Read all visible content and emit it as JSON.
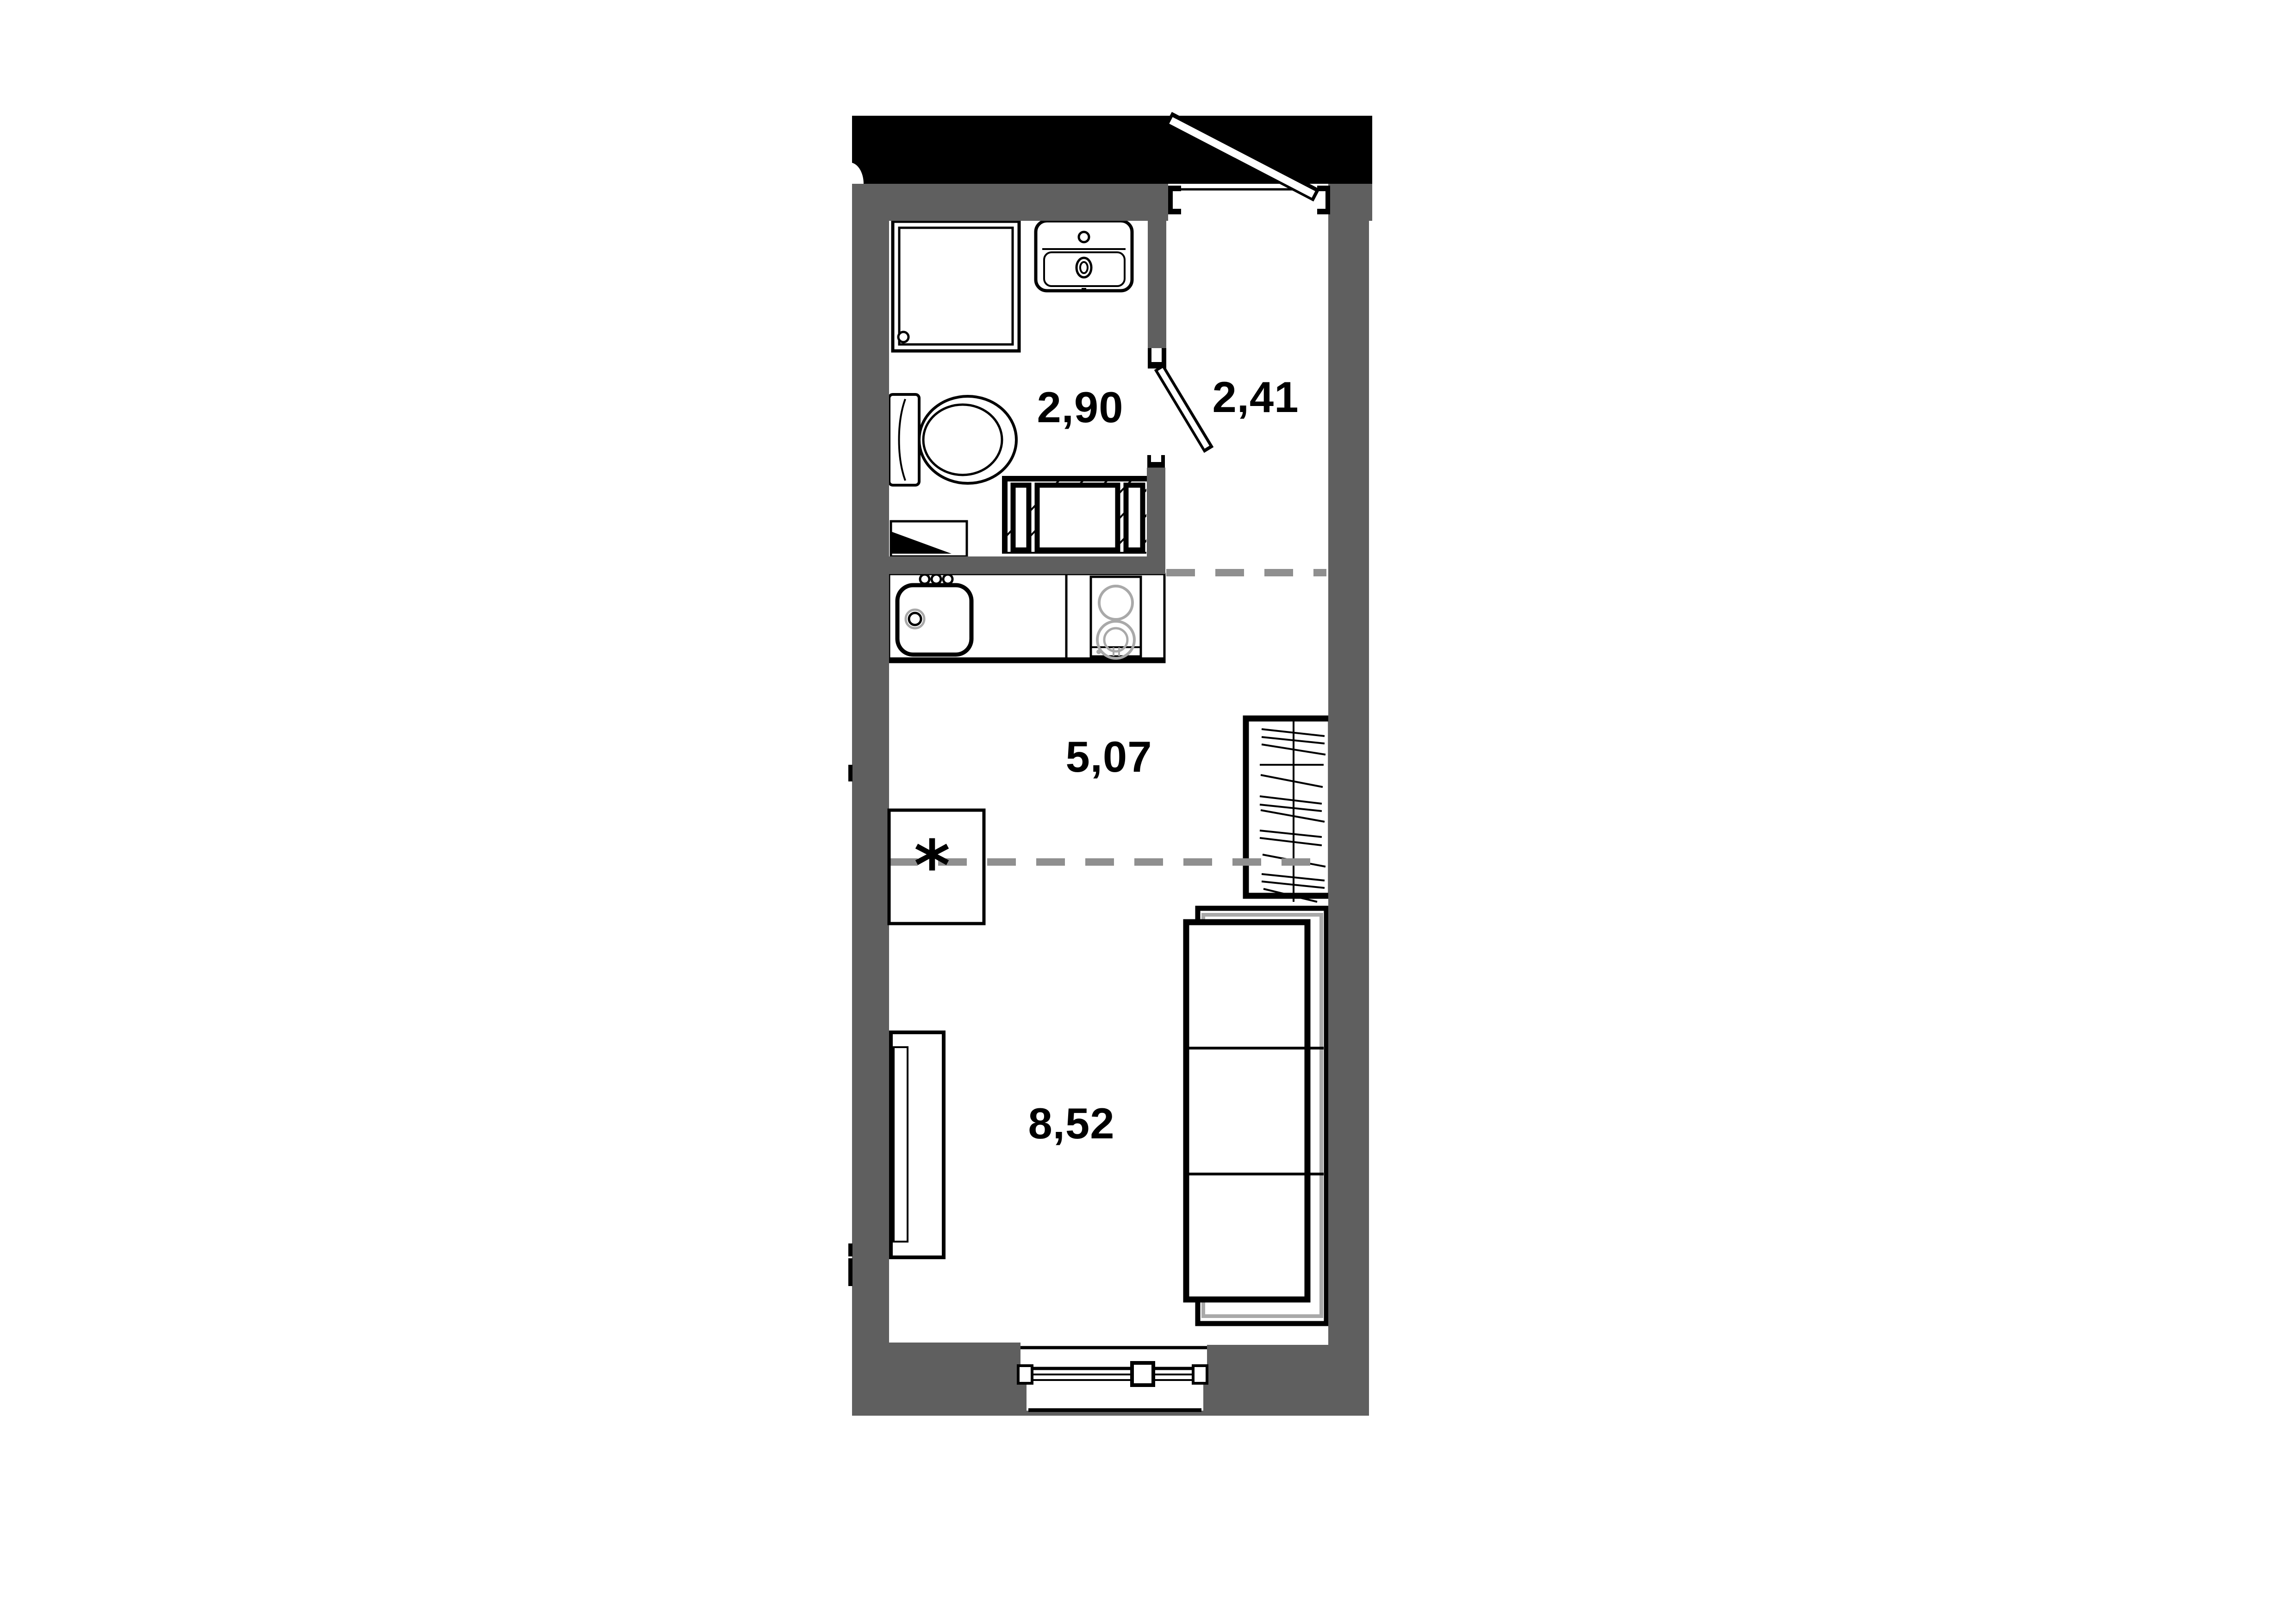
{
  "plan": {
    "rooms": [
      {
        "id": "bathroom",
        "area_label": "2,90"
      },
      {
        "id": "hallway",
        "area_label": "2,41"
      },
      {
        "id": "kitchen",
        "area_label": "5,07"
      },
      {
        "id": "living-room",
        "area_label": "8,52"
      }
    ],
    "marks": {
      "kitchen_footnote": "*",
      "stove_mark": "H"
    }
  },
  "colors": {
    "background": "#ffffff",
    "wall_fill": "#5f5f5f",
    "building_outline": "#000000",
    "zone_dash": "#8f8f8f",
    "sofa_accent": "#a9a9a9",
    "appliance_accent": "#a9a9a9"
  }
}
